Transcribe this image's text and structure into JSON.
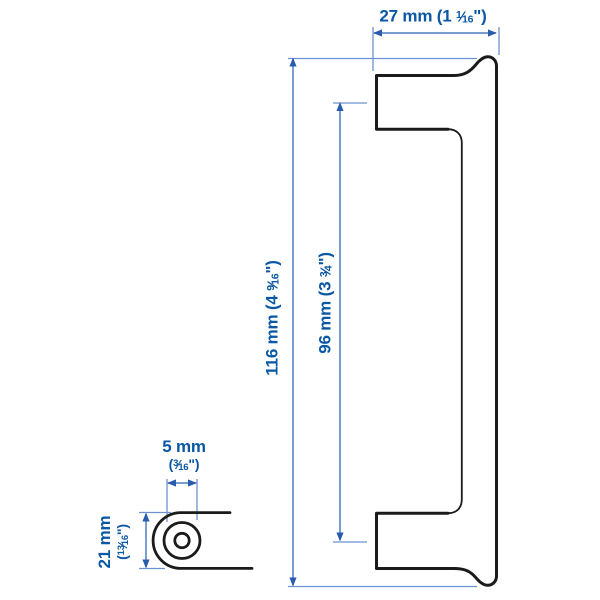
{
  "figure": {
    "kind": "product-dimension-diagram",
    "views": {
      "main": "handle-side-profile",
      "detail": "mounting-end-cross-section"
    }
  },
  "colors": {
    "text": "#0a57a4",
    "dim_line": "#4d7cc2",
    "ext_line": "#6d92cf",
    "arrow": "#2a5cae",
    "outline": "#1b1b1b",
    "background": "#ffffff"
  },
  "fraction_slash": "⁄",
  "dimensions": {
    "width": {
      "mm": "27 mm",
      "inch_prefix": " (1 ",
      "frac_num": "1",
      "frac_den": "16",
      "inch_suffix": "\")"
    },
    "height": {
      "mm": "116 mm",
      "inch_prefix": " (4 ",
      "frac_num": "9",
      "frac_den": "16",
      "inch_suffix": "\")"
    },
    "hole_spacing": {
      "mm": "96 mm",
      "inch_prefix": " (3 ",
      "frac_num": "3",
      "frac_den": "4",
      "inch_suffix": "\")"
    },
    "hole_diameter": {
      "mm": "5 mm",
      "inch_prefix": "(",
      "frac_num": "3",
      "frac_den": "16",
      "inch_suffix": "\")"
    },
    "depth": {
      "mm": "21 mm",
      "inch_prefix": "(",
      "frac_num": "13",
      "frac_den": "16",
      "inch_suffix": "\")"
    }
  }
}
